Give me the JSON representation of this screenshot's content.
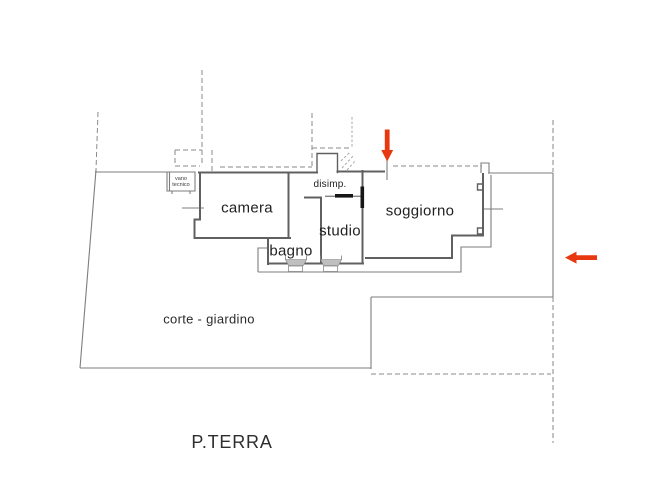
{
  "plan": {
    "floor_label": "P.TERRA",
    "rooms": {
      "camera": {
        "label": "camera"
      },
      "soggiorno": {
        "label": "soggiorno"
      },
      "studio": {
        "label": "studio"
      },
      "bagno": {
        "label": "bagno"
      },
      "disimpegno": {
        "label": "disimp."
      },
      "vano_tecnico": {
        "line1": "vano",
        "line2": "tecnico"
      },
      "corte_giardino": {
        "label": "corte - giardino"
      }
    },
    "colors": {
      "wall": "#606060",
      "thin_line": "#7d7d7d",
      "dashed_line": "#8a8a8a",
      "arrow": "#e8380f",
      "sill": "#bfbfbf",
      "text": "#1f1f1f"
    }
  }
}
